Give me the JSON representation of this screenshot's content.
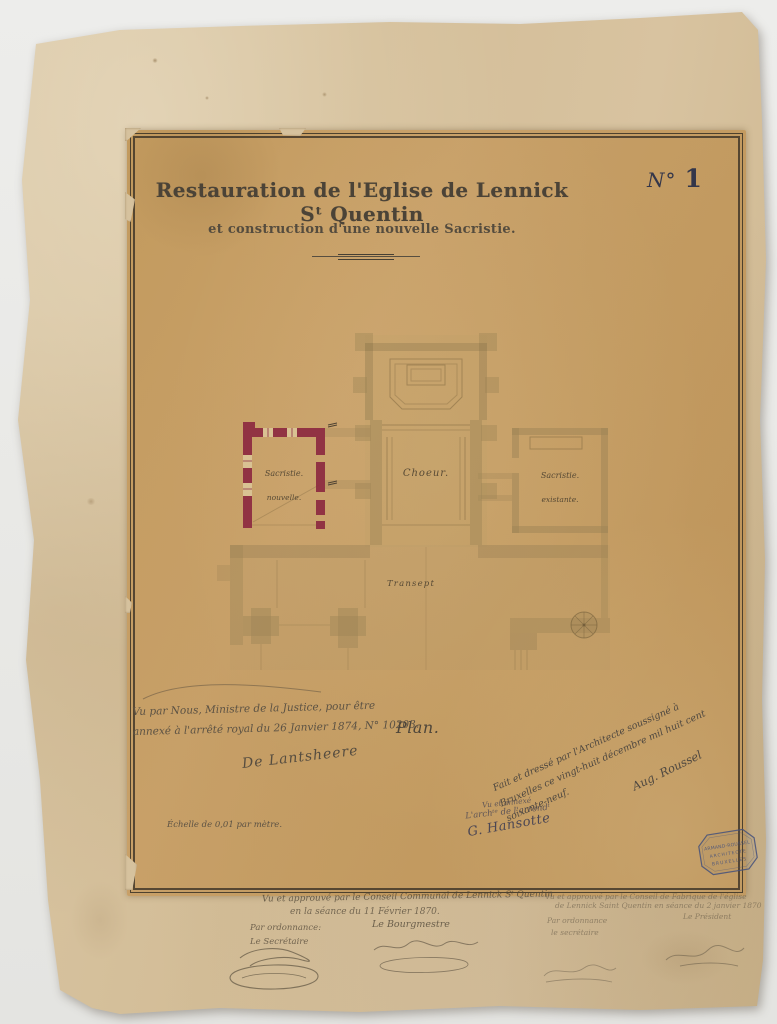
{
  "colors": {
    "new_construction_red": "#8d2a40",
    "stamp_blue": "#44517c",
    "mount_paper": "#d5c19e",
    "sheet_paper": "#c59d62",
    "ink": "#4b4337"
  },
  "header": {
    "number_prefix": "N°",
    "number": "1",
    "title": "Restauration de l'Eglise de Lennick Sᵗ Quentin",
    "subtitle": "et construction d'une nouvelle Sacristie."
  },
  "plan": {
    "caption": "Plan.",
    "scale_note": "Échelle de 0,01 par mètre.",
    "rooms": {
      "choir": "Choeur.",
      "new_sacristy_line1": "Sacristie.",
      "new_sacristy_line2": "nouvelle.",
      "existing_sacristy_line1": "Sacristie.",
      "existing_sacristy_line2": "existante.",
      "transept": "Transept"
    }
  },
  "notes": {
    "minister": {
      "line1": "Vu par Nous, Ministre de la Justice, pour être",
      "line2": "annexé à l'arrêté royal du 26 Janvier 1874, N° 10203.",
      "signature": "De Lantsheere"
    },
    "district_architect": {
      "line1": "Vu et annexé",
      "line2": "L'archᵗᵉ de l'arrondᵗ",
      "signature": "G. Hansotte"
    },
    "architect": {
      "line1": "Fait et dressé par l'Architecte soussigné à",
      "line2": "Bruxelles ce vingt-huit décembre mil huit cent soixante-neuf.",
      "signature": "Aug. Roussel"
    },
    "communal_council": {
      "line1": "Vu et approuvé par le Conseil Communal de Lennick Sᵗ Quentin",
      "line2": "en la séance du 11 Février 1870.",
      "by_order": "Par ordonnance:",
      "secretary": "Le Secrétaire",
      "burgomaster": "Le Bourgmestre"
    },
    "church_council": {
      "line1": "Vu et approuvé par le Conseil de Fabrique de l'église",
      "line2": "de Lennick Saint Quentin en séance du 2 janvier 1870",
      "by_order": "Par ordonnance",
      "secretary": "le secrétaire",
      "president": "Le Président"
    }
  },
  "stamp": {
    "line1": "ARMAND-ROUSSEL",
    "line2": "ARCHITECTE",
    "line3": "BRUXELLES"
  }
}
